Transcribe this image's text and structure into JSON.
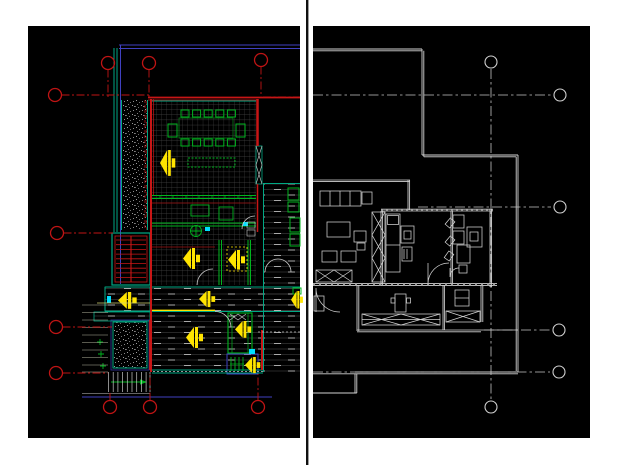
{
  "canvas": {
    "width": 620,
    "height": 465,
    "background": "#ffffff"
  },
  "divider": {
    "x": 306,
    "y": 0,
    "width": 2.4,
    "height": 465,
    "color": "#101010"
  },
  "left_panel": {
    "name": "colored-cad-floor-plan",
    "x": 28,
    "y": 26,
    "width": 272,
    "height": 412,
    "background": "#000000",
    "colors": {
      "red": "#c81616",
      "darkred": "#a01212",
      "teal": "#00a884",
      "green": "#00b41e",
      "dgreen": "#0c7a1a",
      "cyan": "#00e0ff",
      "yellow": "#ffe400",
      "purple": "#4040c0",
      "blue": "#2a2a85",
      "datum": "#c01414"
    },
    "datum_circles": [
      {
        "cx": 108,
        "cy": 63,
        "stem": [
          108,
          69.5,
          108,
          97
        ]
      },
      {
        "cx": 149,
        "cy": 63,
        "stem": [
          149,
          69.5,
          149,
          99
        ]
      },
      {
        "cx": 261,
        "cy": 60,
        "stem": [
          261,
          66.5,
          261,
          97
        ]
      },
      {
        "cx": 55,
        "cy": 95,
        "stem": [
          61.5,
          95,
          150,
          95
        ]
      },
      {
        "cx": 57,
        "cy": 233,
        "stem": [
          63.5,
          233,
          113,
          233
        ]
      },
      {
        "cx": 56,
        "cy": 327,
        "stem": [
          62.5,
          327,
          112,
          327
        ]
      },
      {
        "cx": 56,
        "cy": 373,
        "stem": [
          62.5,
          373,
          108,
          373
        ]
      },
      {
        "cx": 110,
        "cy": 407,
        "stem": [
          110,
          400.5,
          110,
          393
        ]
      },
      {
        "cx": 150,
        "cy": 407,
        "stem": [
          150,
          400.5,
          150,
          374
        ]
      },
      {
        "cx": 258,
        "cy": 407,
        "stem": [
          258,
          400.5,
          258,
          374
        ]
      }
    ],
    "datum_radius": 6.5
  },
  "right_panel": {
    "name": "monochrome-floor-plan",
    "x": 313,
    "y": 26,
    "width": 277,
    "height": 412,
    "background": "#000000",
    "colors": {
      "line": "#d2d2d2",
      "center": "#c4c4c4",
      "datum": "#d0d0d0"
    },
    "datum_circles": [
      {
        "cx": 491,
        "cy": 62
      },
      {
        "cx": 560,
        "cy": 95
      },
      {
        "cx": 560,
        "cy": 207
      },
      {
        "cx": 559,
        "cy": 330
      },
      {
        "cx": 559,
        "cy": 372
      },
      {
        "cx": 491,
        "cy": 407
      }
    ],
    "datum_radius": 6
  }
}
